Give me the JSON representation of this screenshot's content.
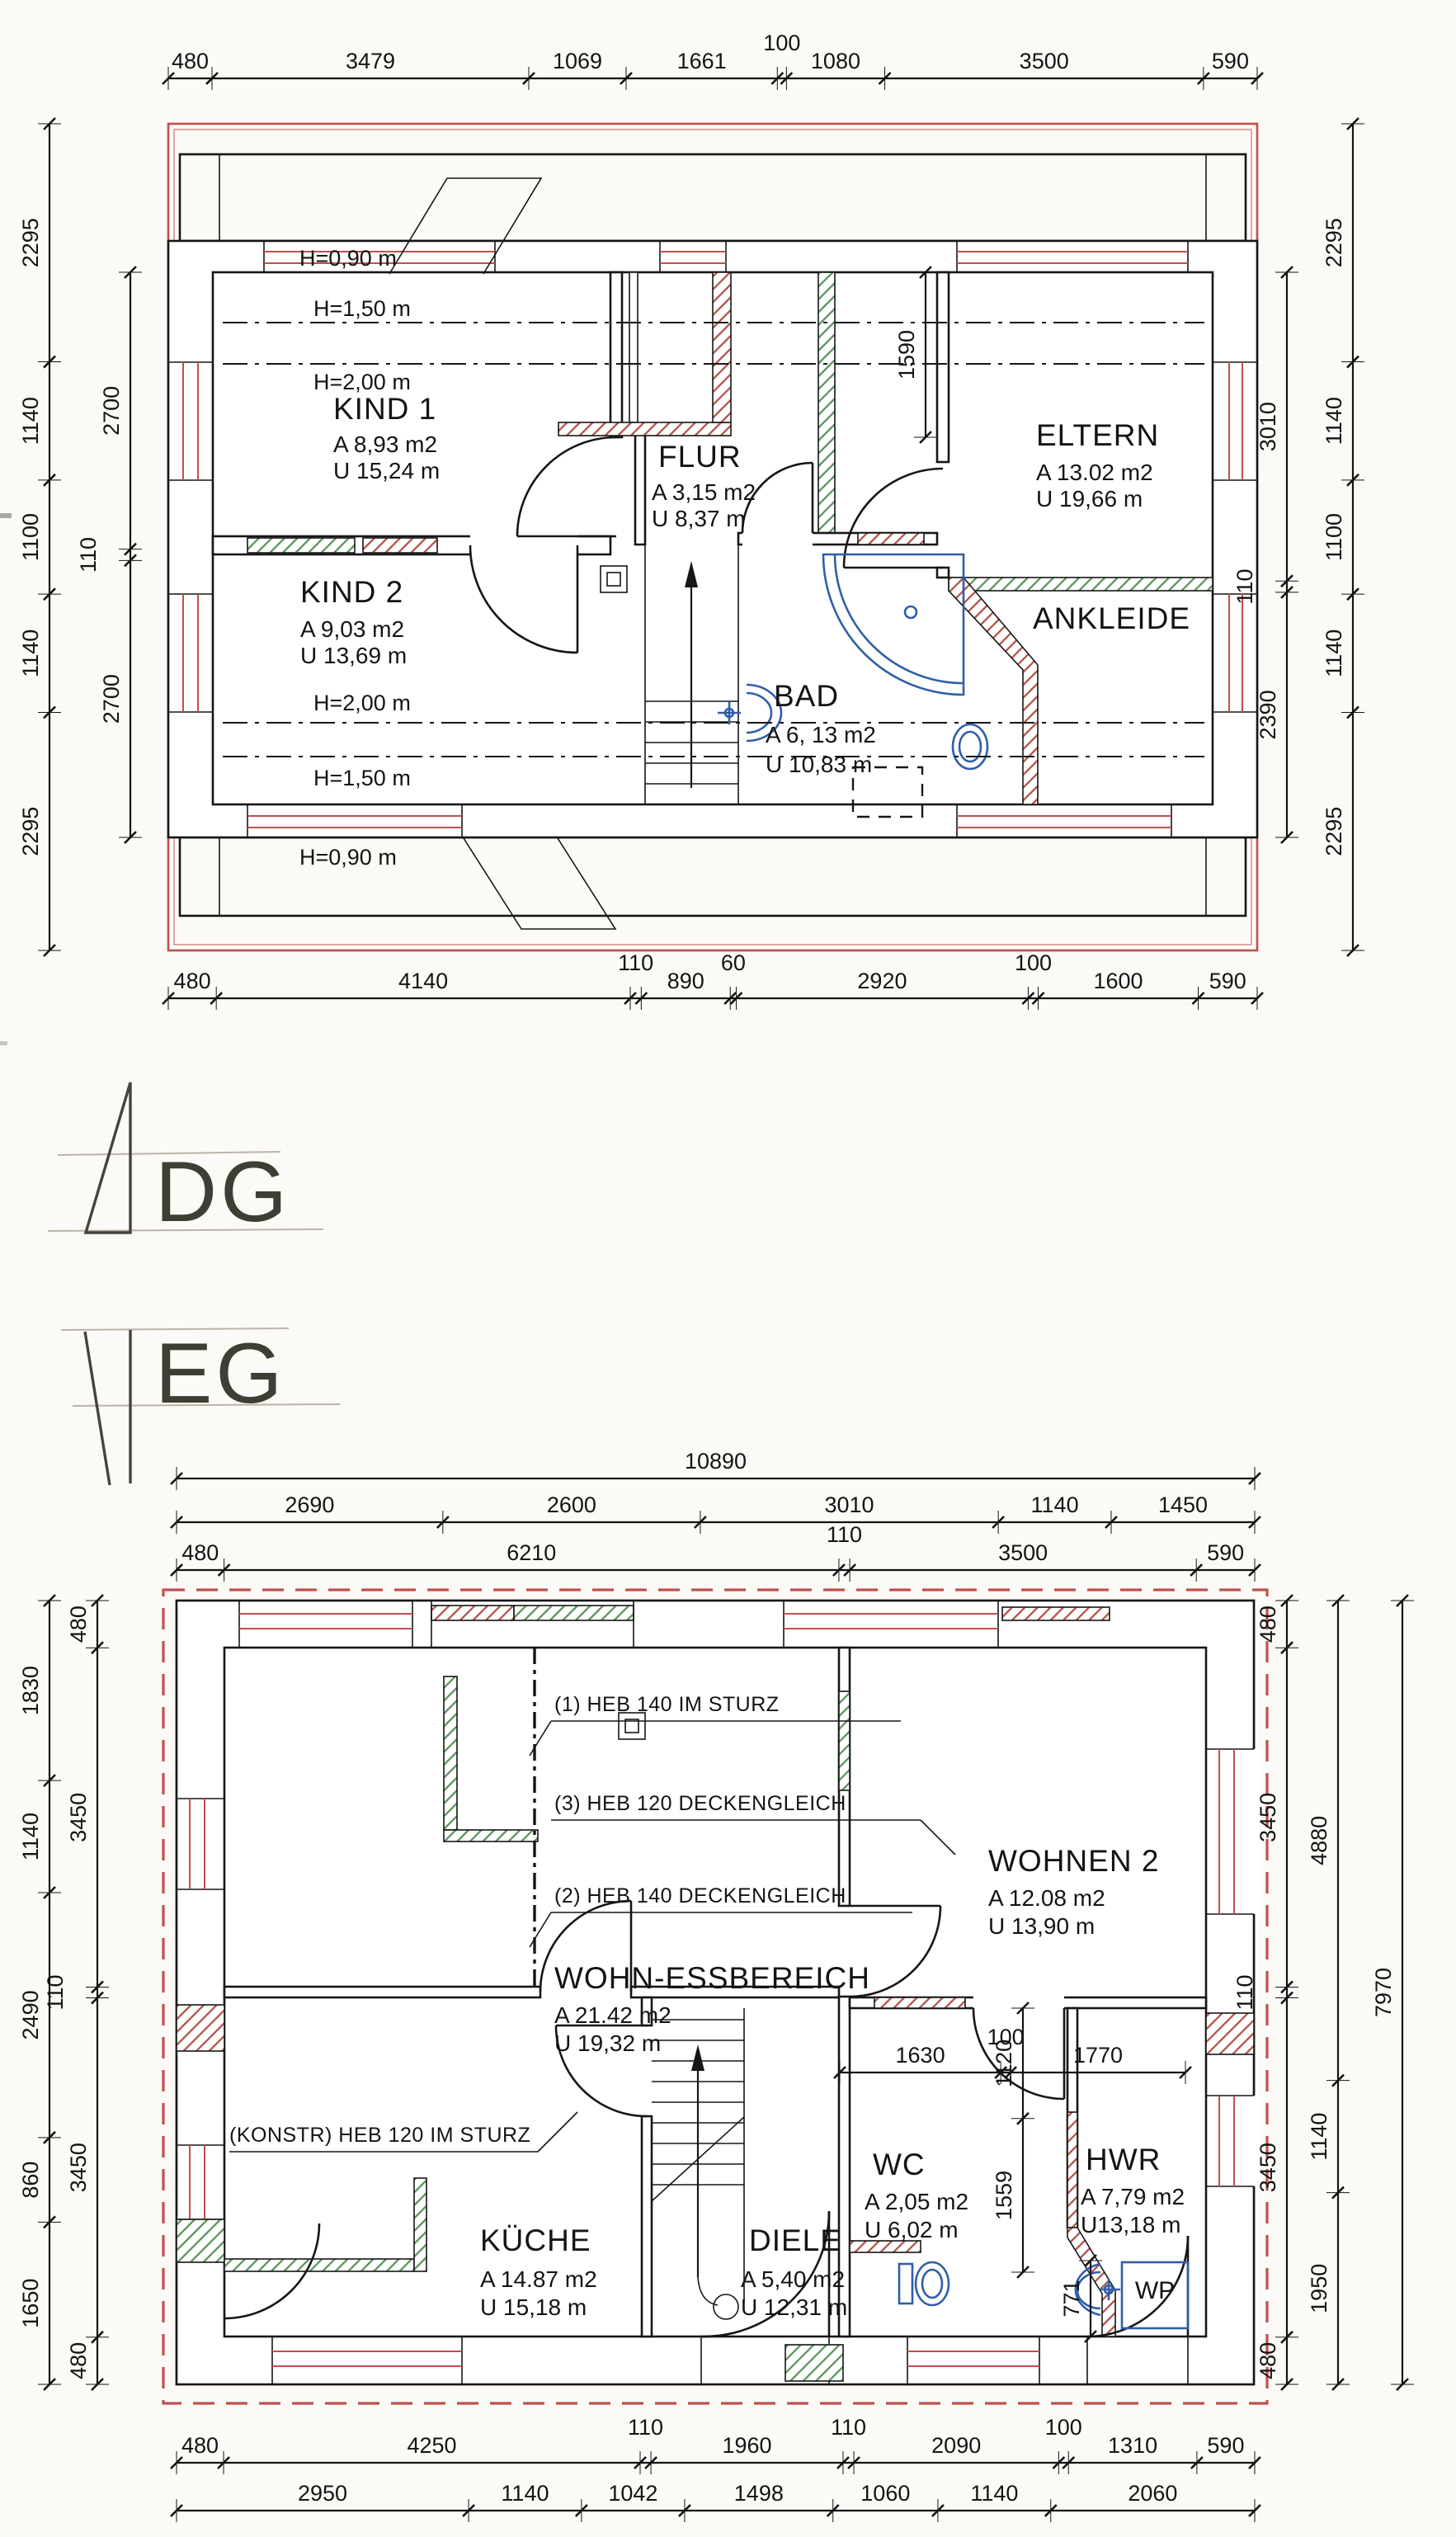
{
  "dg": {
    "floor_label": "DG",
    "dims": {
      "top": [
        "480",
        "3479",
        "1069",
        "1661",
        "100",
        "1080",
        "3500",
        "590"
      ],
      "bottom": [
        "480",
        "4140",
        "110",
        "890",
        "60",
        "2920",
        "100",
        "1600",
        "590"
      ],
      "left_outer": [
        "2295",
        "1140",
        "1100",
        "1140",
        "2295"
      ],
      "left_inner": [
        "2700",
        "110",
        "2700"
      ],
      "right_inner": [
        "3010",
        "110",
        "2390"
      ],
      "right_outer": [
        "2295",
        "1140",
        "1100",
        "1140",
        "2295"
      ],
      "eltern_width": "1590"
    },
    "height_labels": [
      "H=0,90 m",
      "H=1,50 m",
      "H=2,00 m",
      "H=2,00 m",
      "H=1,50 m",
      "H=0,90 m"
    ],
    "rooms": {
      "kind1": {
        "name": "KIND 1",
        "area": "A 8,93 m2",
        "perimeter": "U 15,24 m"
      },
      "kind2": {
        "name": "KIND 2",
        "area": "A 9,03 m2",
        "perimeter": "U 13,69 m"
      },
      "flur": {
        "name": "FLUR",
        "area": "A 3,15 m2",
        "perimeter": "U 8,37 m"
      },
      "eltern": {
        "name": "ELTERN",
        "area": "A 13.02 m2",
        "perimeter": "U 19,66 m"
      },
      "bad": {
        "name": "BAD",
        "area": "A 6, 13 m2",
        "perimeter": "U 10,83 m"
      },
      "ankleide": {
        "name": "ANKLEIDE"
      }
    }
  },
  "eg": {
    "floor_label": "EG",
    "dims": {
      "top_total": "10890",
      "top_mid": [
        "2690",
        "2600",
        "3010",
        "1140",
        "1450"
      ],
      "top_inner": [
        "480",
        "6210",
        "110",
        "3500",
        "590"
      ],
      "bottom_inner": [
        "480",
        "4250",
        "110",
        "1960",
        "110",
        "2090",
        "100",
        "1310",
        "590"
      ],
      "bottom_outer": [
        "2950",
        "1140",
        "1042",
        "1498",
        "1060",
        "1140",
        "2060"
      ],
      "left_outer": [
        "1830",
        "1140",
        "2490",
        "860",
        "1650"
      ],
      "left_inner": [
        "480",
        "3450",
        "110",
        "3450",
        "480"
      ],
      "right_inner": [
        "480",
        "3450",
        "110",
        "3450",
        "480"
      ],
      "right_mid": [
        "4880",
        "1140",
        "1950"
      ],
      "right_total": "7970",
      "wc_chain": [
        "1630",
        "100",
        "1770"
      ],
      "vert_inner": [
        "1120",
        "1559"
      ],
      "hwr_771": "771"
    },
    "notes": [
      "(1) HEB 140 IM STURZ",
      "(3) HEB 120 DECKENGLEICH",
      "(2) HEB 140 DECKENGLEICH",
      "(KONSTR) HEB 120 IM STURZ"
    ],
    "rooms": {
      "wohn": {
        "name": "WOHN-ESSBEREICH",
        "area": "A 21.42 m2",
        "perimeter": "U 19,32 m"
      },
      "wohnen2": {
        "name": "WOHNEN 2",
        "area": "A 12.08 m2",
        "perimeter": "U 13,90 m"
      },
      "kueche": {
        "name": "KÜCHE",
        "area": "A 14.87 m2",
        "perimeter": "U 15,18 m"
      },
      "diele": {
        "name": "DIELE",
        "area": "A 5,40 m2",
        "perimeter": "U 12,31 m"
      },
      "wc": {
        "name": "WC",
        "area": "A 2,05 m2",
        "perimeter": "U 6,02 m"
      },
      "hwr": {
        "name": "HWR",
        "area": "A 7,79 m2",
        "perimeter": "U13,18 m"
      },
      "wp": {
        "name": "WP"
      }
    }
  },
  "colors": {
    "wall": "#161616",
    "red_boundary": "#c0504d",
    "hatch_red": "#a84c40",
    "hatch_green": "#4f8f4f",
    "fixture_blue": "#2f5fa8"
  }
}
